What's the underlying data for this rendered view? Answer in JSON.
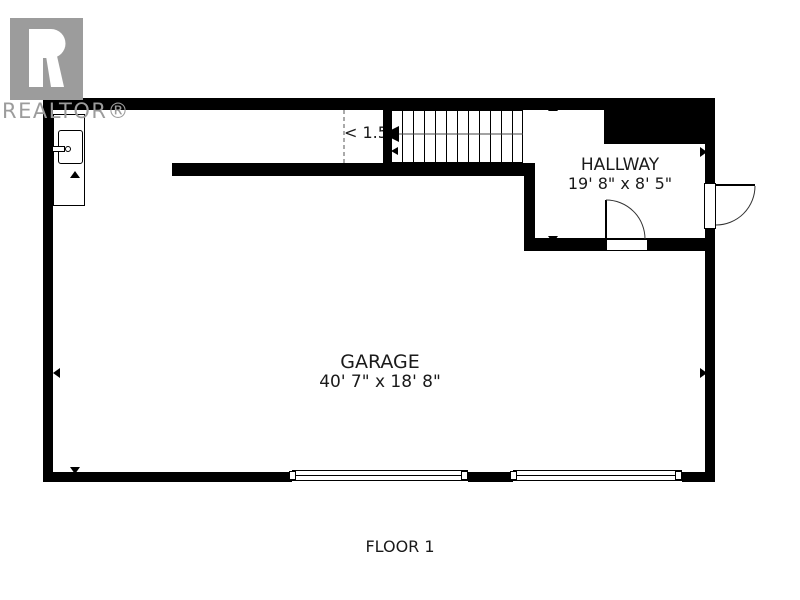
{
  "logo": {
    "brand": "REALTOR®"
  },
  "rooms": {
    "garage": {
      "name": "GARAGE",
      "dimensions": "40' 7\" x 18' 8\""
    },
    "hallway": {
      "name": "HALLWAY",
      "dimensions": "19' 8\" x 8' 5\""
    }
  },
  "annotations": {
    "stair_clearance": "< 1.5"
  },
  "footer": {
    "floor_label": "FLOOR 1"
  },
  "colors": {
    "wall": "#000000",
    "logo_gray": "#9c9c9c",
    "background": "#ffffff"
  }
}
